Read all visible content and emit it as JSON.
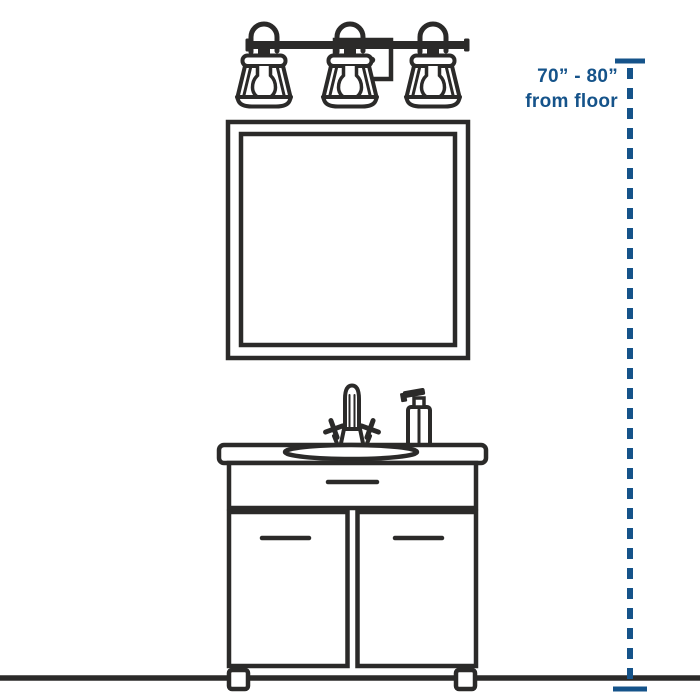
{
  "colors": {
    "line_art": "#2b2a29",
    "accent": "#15538a",
    "background": "#ffffff"
  },
  "annotation": {
    "range": "70” - 80”",
    "reference": "from floor"
  },
  "diagram": {
    "parts": {
      "light_fixture": "three-light-vanity-fixture",
      "mirror": "rectangular-wall-mirror",
      "vanity": "bathroom-vanity-cabinet",
      "sink": "oval-drop-in-sink",
      "faucet": "two-handle-faucet",
      "soap": "soap-dispenser-bottle",
      "floor": "floor-line",
      "dimension": "vertical-dimension-line"
    }
  }
}
